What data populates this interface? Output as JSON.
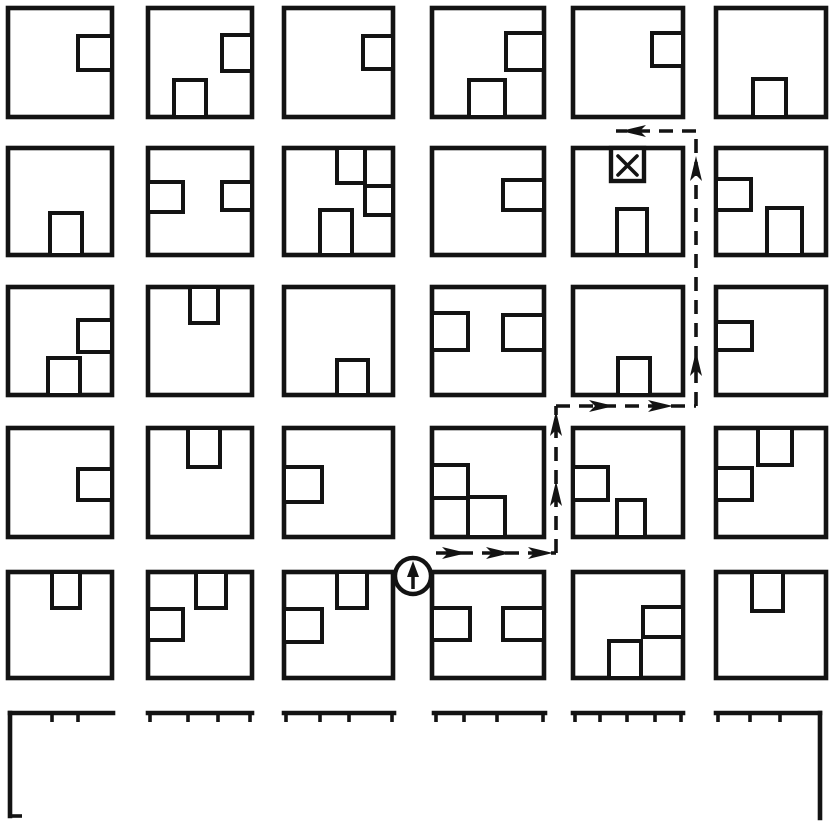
{
  "meta": {
    "figure_kind": "city-block-route-map",
    "canvas_width": 830,
    "canvas_height": 823,
    "background_color": "#ffffff",
    "ink_color": "#131313"
  },
  "style": {
    "block_stroke_width": 4.6,
    "notch_stroke_width": 4.0,
    "partial_stroke_width": 4.6,
    "tick_stroke_width": 3.6,
    "tick_length": 9,
    "route_stroke_width": 3.6,
    "route_dash": "14 9",
    "arrow_length": 25,
    "arrow_half_width": 6,
    "arrow_back_indent": 6,
    "x_stroke_width": 3.6,
    "x_inset": 7,
    "marker_stroke_width": 4.4
  },
  "blocks": [
    {
      "id": "city-block-r0c0",
      "x": 8,
      "y": 8,
      "w": 104,
      "h": 109,
      "notches": [
        {
          "edge": "right",
          "x": 78,
          "y": 36,
          "w": 34,
          "h": 34
        }
      ]
    },
    {
      "id": "city-block-r0c1",
      "x": 148,
      "y": 8,
      "w": 104,
      "h": 109,
      "notches": [
        {
          "edge": "right",
          "x": 222,
          "y": 35,
          "w": 30,
          "h": 36
        },
        {
          "edge": "bottom",
          "x": 174,
          "y": 80,
          "w": 32,
          "h": 37
        }
      ]
    },
    {
      "id": "city-block-r0c2",
      "x": 284,
      "y": 8,
      "w": 109,
      "h": 109,
      "notches": [
        {
          "edge": "right",
          "x": 363,
          "y": 36,
          "w": 30,
          "h": 33
        }
      ]
    },
    {
      "id": "city-block-r0c3",
      "x": 432,
      "y": 8,
      "w": 112,
      "h": 109,
      "notches": [
        {
          "edge": "right",
          "x": 506,
          "y": 33,
          "w": 38,
          "h": 37
        },
        {
          "edge": "bottom",
          "x": 469,
          "y": 80,
          "w": 36,
          "h": 37
        }
      ]
    },
    {
      "id": "city-block-r0c4",
      "x": 573,
      "y": 8,
      "w": 110,
      "h": 109,
      "notches": [
        {
          "edge": "right",
          "x": 652,
          "y": 33,
          "w": 31,
          "h": 33
        }
      ]
    },
    {
      "id": "city-block-r0c5",
      "x": 716,
      "y": 8,
      "w": 110,
      "h": 109,
      "notches": [
        {
          "edge": "bottom",
          "x": 753,
          "y": 79,
          "w": 33,
          "h": 38
        }
      ]
    },
    {
      "id": "city-block-r1c0",
      "x": 8,
      "y": 148,
      "w": 104,
      "h": 107,
      "notches": [
        {
          "edge": "bottom",
          "x": 50,
          "y": 213,
          "w": 32,
          "h": 42
        }
      ]
    },
    {
      "id": "city-block-r1c1",
      "x": 148,
      "y": 148,
      "w": 104,
      "h": 107,
      "notches": [
        {
          "edge": "left",
          "x": 148,
          "y": 182,
          "w": 35,
          "h": 30
        },
        {
          "edge": "right",
          "x": 222,
          "y": 182,
          "w": 30,
          "h": 28
        }
      ]
    },
    {
      "id": "city-block-r1c2",
      "x": 284,
      "y": 148,
      "w": 109,
      "h": 107,
      "notches": [
        {
          "edge": "top",
          "x": 337,
          "y": 148,
          "w": 28,
          "h": 35
        },
        {
          "edge": "right",
          "x": 365,
          "y": 186,
          "w": 28,
          "h": 29
        },
        {
          "edge": "bottom",
          "x": 320,
          "y": 210,
          "w": 32,
          "h": 45
        }
      ]
    },
    {
      "id": "city-block-r1c3",
      "x": 432,
      "y": 148,
      "w": 112,
      "h": 107,
      "notches": [
        {
          "edge": "right",
          "x": 503,
          "y": 180,
          "w": 41,
          "h": 30
        }
      ]
    },
    {
      "id": "city-block-r1c4",
      "x": 573,
      "y": 148,
      "w": 110,
      "h": 107,
      "notches": [
        {
          "edge": "bottom",
          "x": 617,
          "y": 209,
          "w": 30,
          "h": 46
        }
      ]
    },
    {
      "id": "city-block-r1c5",
      "x": 716,
      "y": 148,
      "w": 110,
      "h": 107,
      "notches": [
        {
          "edge": "left",
          "x": 716,
          "y": 179,
          "w": 35,
          "h": 31
        },
        {
          "edge": "bottom",
          "x": 767,
          "y": 208,
          "w": 35,
          "h": 47
        }
      ]
    },
    {
      "id": "city-block-r2c0",
      "x": 8,
      "y": 287,
      "w": 104,
      "h": 108,
      "notches": [
        {
          "edge": "right",
          "x": 78,
          "y": 320,
          "w": 34,
          "h": 32
        },
        {
          "edge": "bottom",
          "x": 48,
          "y": 358,
          "w": 32,
          "h": 37
        }
      ]
    },
    {
      "id": "city-block-r2c1",
      "x": 148,
      "y": 287,
      "w": 104,
      "h": 108,
      "notches": [
        {
          "edge": "top",
          "x": 190,
          "y": 287,
          "w": 28,
          "h": 36
        }
      ]
    },
    {
      "id": "city-block-r2c2",
      "x": 284,
      "y": 287,
      "w": 109,
      "h": 108,
      "notches": [
        {
          "edge": "bottom",
          "x": 337,
          "y": 360,
          "w": 31,
          "h": 35
        }
      ]
    },
    {
      "id": "city-block-r2c3",
      "x": 432,
      "y": 287,
      "w": 112,
      "h": 108,
      "notches": [
        {
          "edge": "left",
          "x": 432,
          "y": 313,
          "w": 36,
          "h": 37
        },
        {
          "edge": "right",
          "x": 503,
          "y": 315,
          "w": 41,
          "h": 35
        }
      ]
    },
    {
      "id": "city-block-r2c4",
      "x": 573,
      "y": 287,
      "w": 110,
      "h": 108,
      "notches": [
        {
          "edge": "bottom",
          "x": 618,
          "y": 358,
          "w": 32,
          "h": 37
        }
      ]
    },
    {
      "id": "city-block-r2c5",
      "x": 716,
      "y": 287,
      "w": 110,
      "h": 108,
      "notches": [
        {
          "edge": "left",
          "x": 716,
          "y": 322,
          "w": 36,
          "h": 28
        }
      ]
    },
    {
      "id": "city-block-r3c0",
      "x": 8,
      "y": 428,
      "w": 104,
      "h": 109,
      "notches": [
        {
          "edge": "right",
          "x": 78,
          "y": 469,
          "w": 34,
          "h": 31
        }
      ]
    },
    {
      "id": "city-block-r3c1",
      "x": 148,
      "y": 428,
      "w": 104,
      "h": 109,
      "notches": [
        {
          "edge": "top",
          "x": 188,
          "y": 428,
          "w": 32,
          "h": 39
        }
      ]
    },
    {
      "id": "city-block-r3c2",
      "x": 284,
      "y": 428,
      "w": 109,
      "h": 109,
      "notches": [
        {
          "edge": "left",
          "x": 284,
          "y": 467,
          "w": 38,
          "h": 35
        }
      ]
    },
    {
      "id": "city-block-r3c3",
      "x": 432,
      "y": 428,
      "w": 112,
      "h": 109,
      "notches": [
        {
          "edge": "left",
          "x": 432,
          "y": 465,
          "w": 36,
          "h": 33
        },
        {
          "edge": "bottom",
          "x": 468,
          "y": 497,
          "w": 37,
          "h": 40
        }
      ]
    },
    {
      "id": "city-block-r3c4",
      "x": 573,
      "y": 428,
      "w": 110,
      "h": 109,
      "notches": [
        {
          "edge": "left",
          "x": 573,
          "y": 467,
          "w": 35,
          "h": 33
        },
        {
          "edge": "bottom",
          "x": 617,
          "y": 500,
          "w": 28,
          "h": 37
        }
      ]
    },
    {
      "id": "city-block-r3c5",
      "x": 716,
      "y": 428,
      "w": 110,
      "h": 109,
      "notches": [
        {
          "edge": "top",
          "x": 758,
          "y": 428,
          "w": 34,
          "h": 37
        },
        {
          "edge": "left",
          "x": 716,
          "y": 468,
          "w": 36,
          "h": 32
        }
      ]
    },
    {
      "id": "city-block-r4c0",
      "x": 8,
      "y": 572,
      "w": 104,
      "h": 106,
      "notches": [
        {
          "edge": "top",
          "x": 52,
          "y": 572,
          "w": 28,
          "h": 36
        }
      ]
    },
    {
      "id": "city-block-r4c1",
      "x": 148,
      "y": 572,
      "w": 104,
      "h": 106,
      "notches": [
        {
          "edge": "top",
          "x": 196,
          "y": 572,
          "w": 30,
          "h": 36
        },
        {
          "edge": "left",
          "x": 148,
          "y": 609,
          "w": 35,
          "h": 31
        }
      ]
    },
    {
      "id": "city-block-r4c2",
      "x": 284,
      "y": 572,
      "w": 109,
      "h": 106,
      "notches": [
        {
          "edge": "top",
          "x": 337,
          "y": 572,
          "w": 30,
          "h": 36
        },
        {
          "edge": "left",
          "x": 284,
          "y": 609,
          "w": 38,
          "h": 33
        }
      ]
    },
    {
      "id": "city-block-r4c3",
      "x": 432,
      "y": 572,
      "w": 112,
      "h": 106,
      "notches": [
        {
          "edge": "left",
          "x": 432,
          "y": 608,
          "w": 38,
          "h": 32
        },
        {
          "edge": "right",
          "x": 503,
          "y": 608,
          "w": 41,
          "h": 32
        }
      ]
    },
    {
      "id": "city-block-r4c4",
      "x": 573,
      "y": 572,
      "w": 110,
      "h": 106,
      "notches": [
        {
          "edge": "right",
          "x": 643,
          "y": 607,
          "w": 40,
          "h": 30
        },
        {
          "edge": "bottom",
          "x": 609,
          "y": 641,
          "w": 32,
          "h": 37
        }
      ]
    },
    {
      "id": "city-block-r4c5",
      "x": 716,
      "y": 572,
      "w": 110,
      "h": 106,
      "notches": [
        {
          "edge": "top",
          "x": 752,
          "y": 572,
          "w": 31,
          "h": 39
        }
      ]
    }
  ],
  "partial_row": {
    "y": 713,
    "segments": [
      {
        "id": "partial-block-r5c0",
        "x1": 10,
        "x2": 113,
        "ticks": [
          52,
          78
        ],
        "left_drop": {
          "y2": 816,
          "foot": 12
        }
      },
      {
        "id": "partial-block-r5c1",
        "x1": 148,
        "x2": 252,
        "ticks": [
          150,
          188,
          218,
          250
        ]
      },
      {
        "id": "partial-block-r5c2",
        "x1": 284,
        "x2": 394,
        "ticks": [
          286,
          320,
          349,
          392
        ]
      },
      {
        "id": "partial-block-r5c3",
        "x1": 434,
        "x2": 545,
        "ticks": [
          436,
          464,
          497,
          543
        ]
      },
      {
        "id": "partial-block-r5c4",
        "x1": 573,
        "x2": 683,
        "ticks": [
          575,
          600,
          627,
          655,
          681
        ]
      },
      {
        "id": "partial-block-r5c5",
        "x1": 716,
        "x2": 820,
        "ticks": [
          718,
          750,
          780
        ],
        "right_drop": {
          "y2": 818
        }
      }
    ]
  },
  "route": {
    "points": [
      [
        436,
        553
      ],
      [
        556,
        553
      ],
      [
        556,
        406
      ],
      [
        696,
        406
      ],
      [
        696,
        131
      ],
      [
        616,
        131
      ]
    ],
    "arrows": [
      {
        "tip": [
          467,
          553
        ],
        "dir": "right"
      },
      {
        "tip": [
          511,
          553
        ],
        "dir": "right"
      },
      {
        "tip": [
          553,
          553
        ],
        "dir": "right"
      },
      {
        "tip": [
          556,
          481
        ],
        "dir": "up"
      },
      {
        "tip": [
          556,
          411
        ],
        "dir": "up"
      },
      {
        "tip": [
          614,
          406
        ],
        "dir": "right"
      },
      {
        "tip": [
          673,
          406
        ],
        "dir": "right"
      },
      {
        "tip": [
          696,
          351
        ],
        "dir": "up"
      },
      {
        "tip": [
          696,
          156
        ],
        "dir": "up"
      },
      {
        "tip": [
          621,
          131
        ],
        "dir": "left"
      }
    ]
  },
  "start_marker": {
    "cx": 413,
    "cy": 576,
    "r": 18
  },
  "destination_marker": {
    "x": 611,
    "y": 148,
    "w": 33,
    "h": 33
  }
}
